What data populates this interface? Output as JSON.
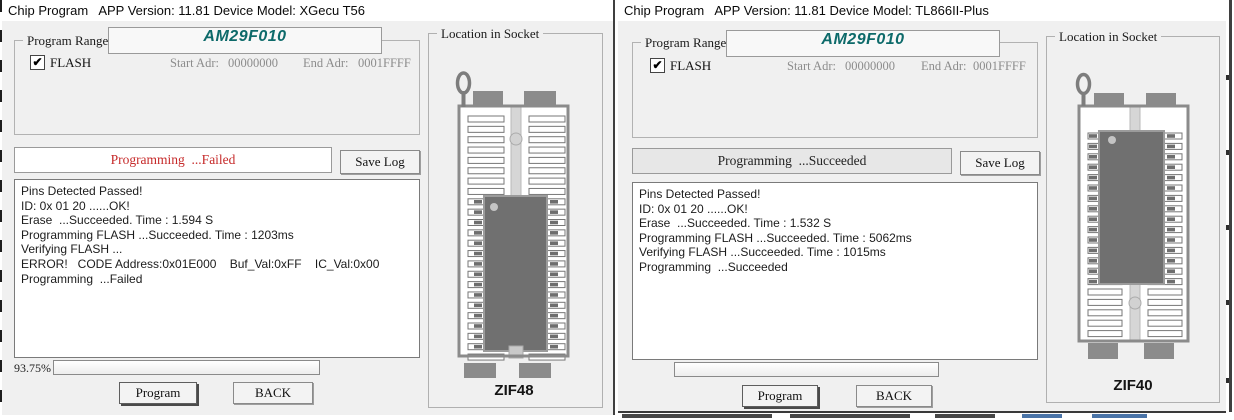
{
  "windows": [
    {
      "title": "Chip Program   APP Version: 11.81 Device Model: XGecu T56",
      "program_range": {
        "group_label": "Program Range",
        "chip_name": "AM29F010",
        "flash_label": "FLASH",
        "flash_checked": true,
        "start_adr_label": "Start Adr:",
        "start_adr_value": "00000000",
        "end_adr_label": "End Adr:",
        "end_adr_value": "0001FFFF"
      },
      "status": {
        "text": "Programming  ...Failed",
        "color": "#c62a2a",
        "bg": "#ffffff"
      },
      "save_log_label": "Save Log",
      "log_lines": [
        "Pins Detected Passed!",
        "ID: 0x 01 20 ......OK!",
        "Erase  ...Succeeded. Time : 1.594 S",
        "Programming FLASH ...Succeeded. Time : 1203ms",
        "Verifying FLASH ...",
        "ERROR!   CODE Address:0x01E000    Buf_Val:0xFF    IC_Val:0x00",
        "Programming  ...Failed"
      ],
      "progress": {
        "label": "93.75%",
        "percent": 0
      },
      "program_button": "Program",
      "back_button": "BACK",
      "socket": {
        "group_label": "Location in Socket",
        "name": "ZIF48",
        "pin_count": 48,
        "chip_position": "bottom"
      }
    },
    {
      "title": "Chip Program   APP Version: 11.81 Device Model: TL866II-Plus",
      "program_range": {
        "group_label": "Program Range",
        "chip_name": "AM29F010",
        "flash_label": "FLASH",
        "flash_checked": true,
        "start_adr_label": "Start Adr:",
        "start_adr_value": "00000000",
        "end_adr_label": "End Adr:",
        "end_adr_value": "0001FFFF"
      },
      "status": {
        "text": "Programming  ...Succeeded",
        "color": "#222222",
        "bg": "#e7e7e7"
      },
      "save_log_label": "Save Log",
      "log_lines": [
        "Pins Detected Passed!",
        "ID: 0x 01 20 ......OK!",
        "Erase  ...Succeeded. Time : 1.532 S",
        "Programming FLASH ...Succeeded. Time : 5062ms",
        "Verifying FLASH ...Succeeded. Time : 1015ms",
        "Programming  ...Succeeded"
      ],
      "progress": {
        "label": "",
        "percent": 0
      },
      "program_button": "Program",
      "back_button": "BACK",
      "socket": {
        "group_label": "Location in Socket",
        "name": "ZIF40",
        "pin_count": 40,
        "chip_position": "top"
      }
    }
  ]
}
